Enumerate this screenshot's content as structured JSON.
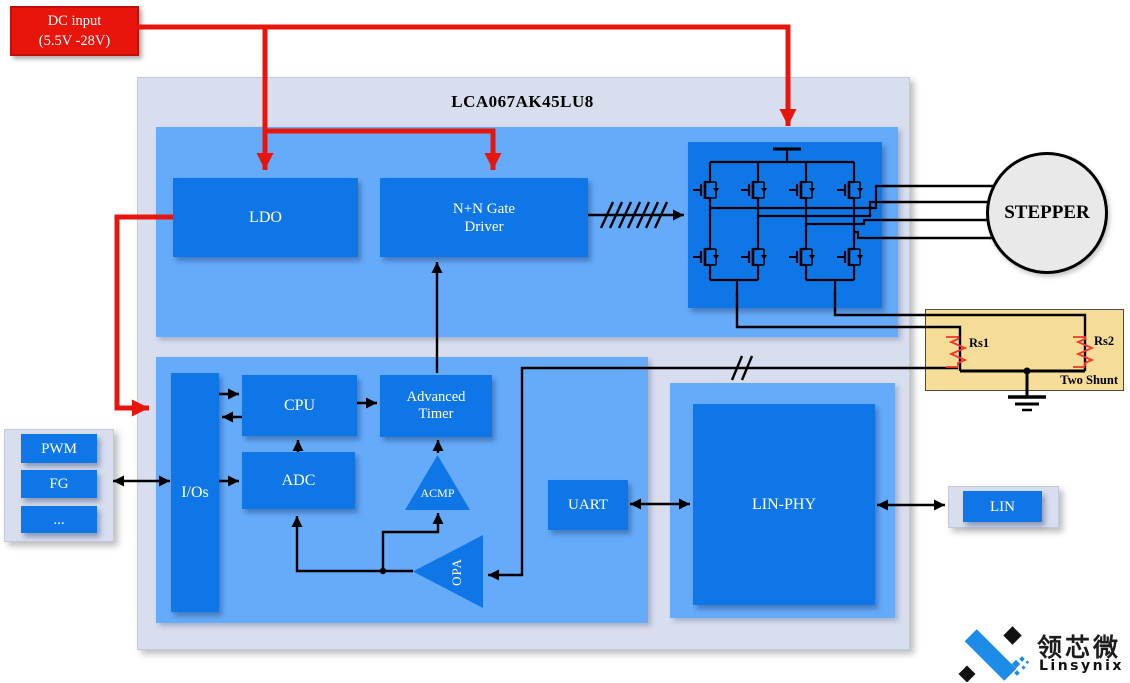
{
  "diagram": {
    "dc_input": {
      "lines": [
        "DC input",
        "(5.5V -28V)"
      ]
    },
    "chip": {
      "title": "LCA067AK45LU8"
    },
    "blocks": {
      "ldo": "LDO",
      "gate_driver": [
        "N+N Gate",
        "Driver"
      ],
      "cpu": "CPU",
      "adc": "ADC",
      "adv_timer": [
        "Advanced",
        "Timer"
      ],
      "acmp": "ACMP",
      "opa": "OPA",
      "ios": "I/Os",
      "uart": "UART",
      "lin_phy": "LIN-PHY"
    },
    "io_panel": {
      "pwm": "PWM",
      "fg": "FG",
      "more": "..."
    },
    "lin_panel": {
      "lin": "LIN"
    },
    "motor": {
      "label": "STEPPER"
    },
    "shunt": {
      "rs1": "Rs1",
      "rs2": "Rs2",
      "caption": "Two Shunt"
    },
    "logo": {
      "cn": "领芯微",
      "en": "Linsynix"
    },
    "buses": {
      "gate_bus_slashes": 7,
      "feedback_slashes": 2
    },
    "colors": {
      "red": "#e8150d",
      "panel": "#d9deef",
      "region_blue": "#66abfa",
      "block_blue": "#0f76e8",
      "shunt_bg": "#f6dd97",
      "logo_blue": "#1d8ce9"
    }
  }
}
